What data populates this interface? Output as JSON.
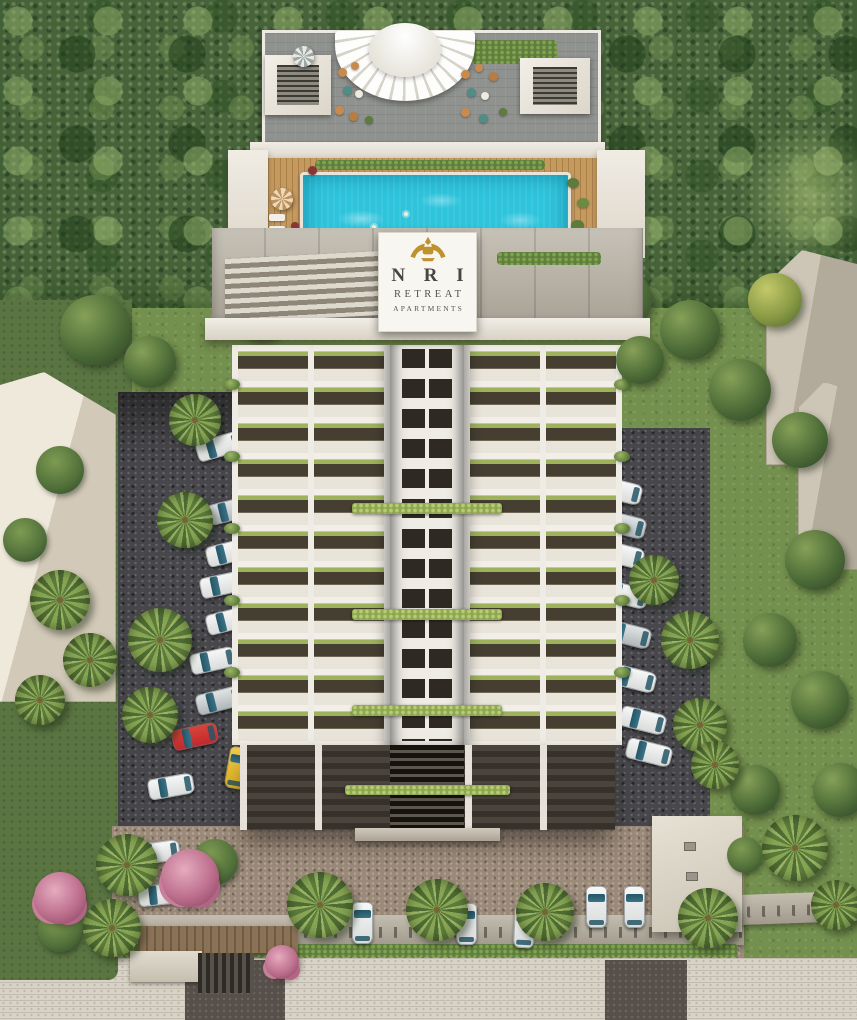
{
  "scene": {
    "description": "Aerial 3D architectural rendering of a residential high-rise with rooftop pool, landscaped grounds, parking and forest backdrop",
    "building_name": "NRI Retreat Apartments"
  },
  "signboard": {
    "line1": "N R I",
    "line2": "RETREAT",
    "line3": "APARTMENTS",
    "emblem": "gold-garuda-crest"
  },
  "colors": {
    "pool_water": "#2ec4dc",
    "deck_wood": "#c59a5f",
    "facade_white": "#efece5",
    "sign_gold": "#c0912f",
    "sign_text": "#4a4540",
    "forest_green": "#46633a",
    "lawn_green": "#74904e",
    "lawn_dark": "#5a7442",
    "cobble": "#47474c",
    "paver_brown": "#9b8a7a",
    "car_white": "#d8dbda",
    "car_glass": "#245666",
    "car_red": "#c1272d",
    "car_yellow": "#e4b51f",
    "hedge_green": "#5f7f3e",
    "wall_grey": "#b5ae9f",
    "sidewalk": "#d8d3c6",
    "road_dark": "#57504a",
    "neighbor_beige": "#c9c1b2",
    "gate_brown": "#8a7256"
  }
}
